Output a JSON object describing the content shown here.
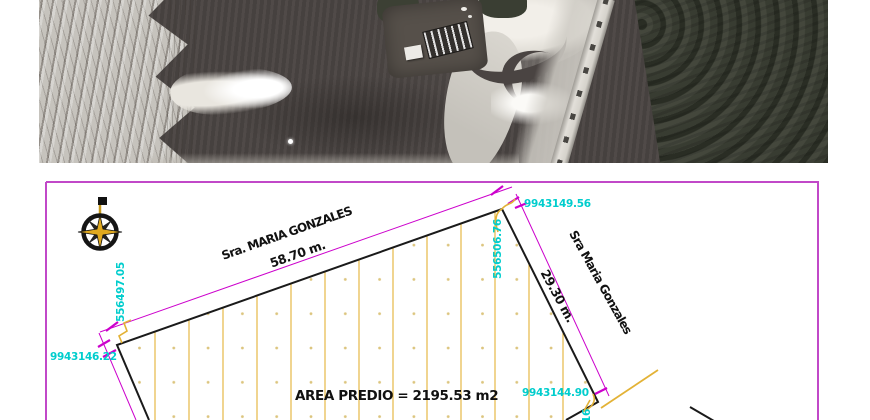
{
  "satellite": {
    "palette": {
      "water": "#4a4442",
      "sand_bank": "#c6c3bd",
      "bright_sand": "#f7f5f0",
      "vegetation": "#3f4238",
      "road": "#d8d5ce"
    }
  },
  "plan": {
    "colors": {
      "frame": "#c148c8",
      "boundary": "#1a1a1a",
      "hatch": "#e3b236",
      "hatch_dot": "#dcc57e",
      "dimension": "#cc00cc",
      "coordinate": "#00cdcd",
      "compass_gold": "#e0a91f"
    },
    "labels": {
      "owner_top": "Sra. MARIA GONZALES",
      "dim_top": "58.70 m.",
      "owner_right": "Sra Maria Gonzales",
      "dim_right": "29.30 m.",
      "area": "AREA PREDIO = 2195.53 m2"
    },
    "coordinates": {
      "top_right_north": "9943149.56",
      "top_right_east": "556506.76",
      "left_east": "556497.05",
      "left_north": "9943146.22",
      "bottom_right_north": "9943144.90",
      "bottom_right_east_partial": "16"
    }
  }
}
